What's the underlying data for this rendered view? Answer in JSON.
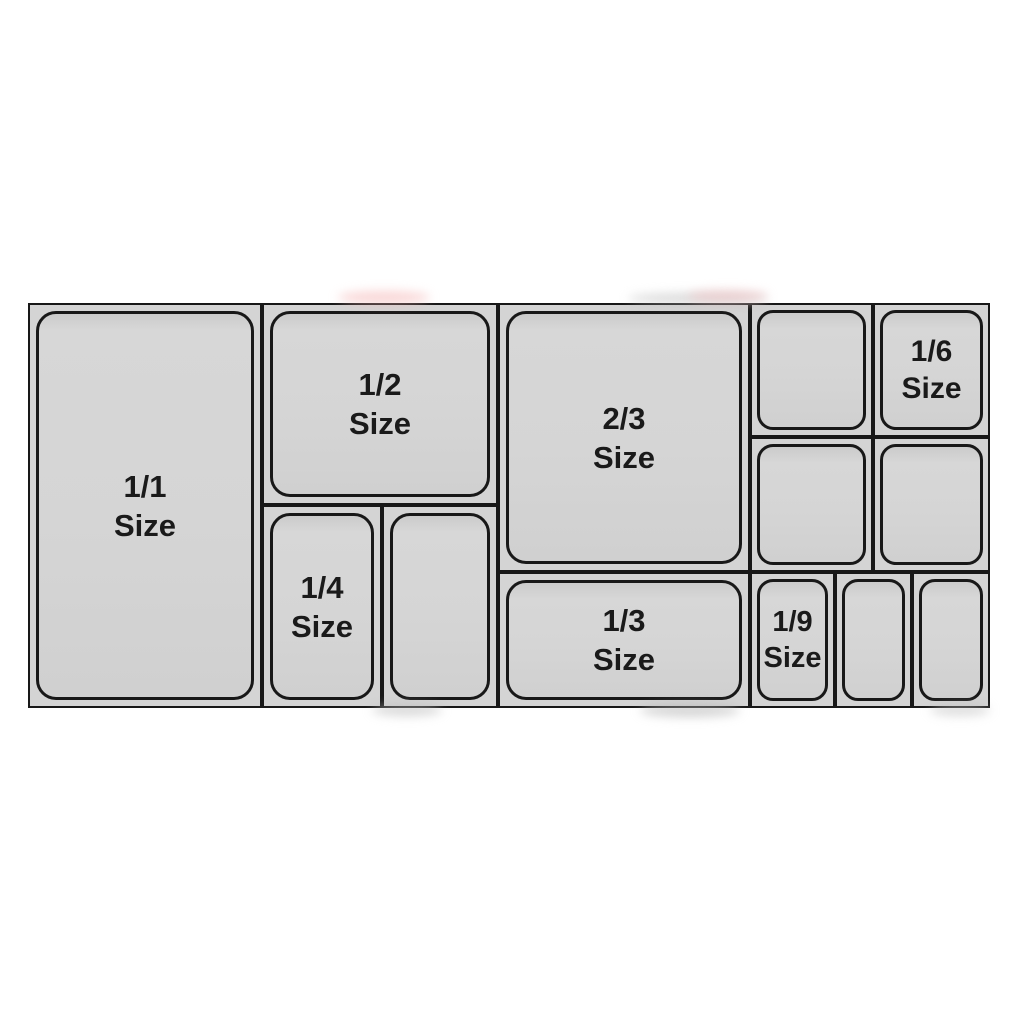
{
  "diagram": {
    "pan_fill_color": "#d4d4d4",
    "line_color": "#181818",
    "text_color": "#1a1a1a",
    "background_color": "#ffffff",
    "labels": {
      "full": {
        "line1": "1/1",
        "line2": "Size"
      },
      "half": {
        "line1": "1/2",
        "line2": "Size"
      },
      "two_thirds": {
        "line1": "2/3",
        "line2": "Size"
      },
      "third": {
        "line1": "1/3",
        "line2": "Size"
      },
      "quarter": {
        "line1": "1/4",
        "line2": "Size"
      },
      "sixth": {
        "line1": "1/6",
        "line2": "Size"
      },
      "ninth": {
        "line1": "1/9",
        "line2": "Size"
      }
    }
  }
}
